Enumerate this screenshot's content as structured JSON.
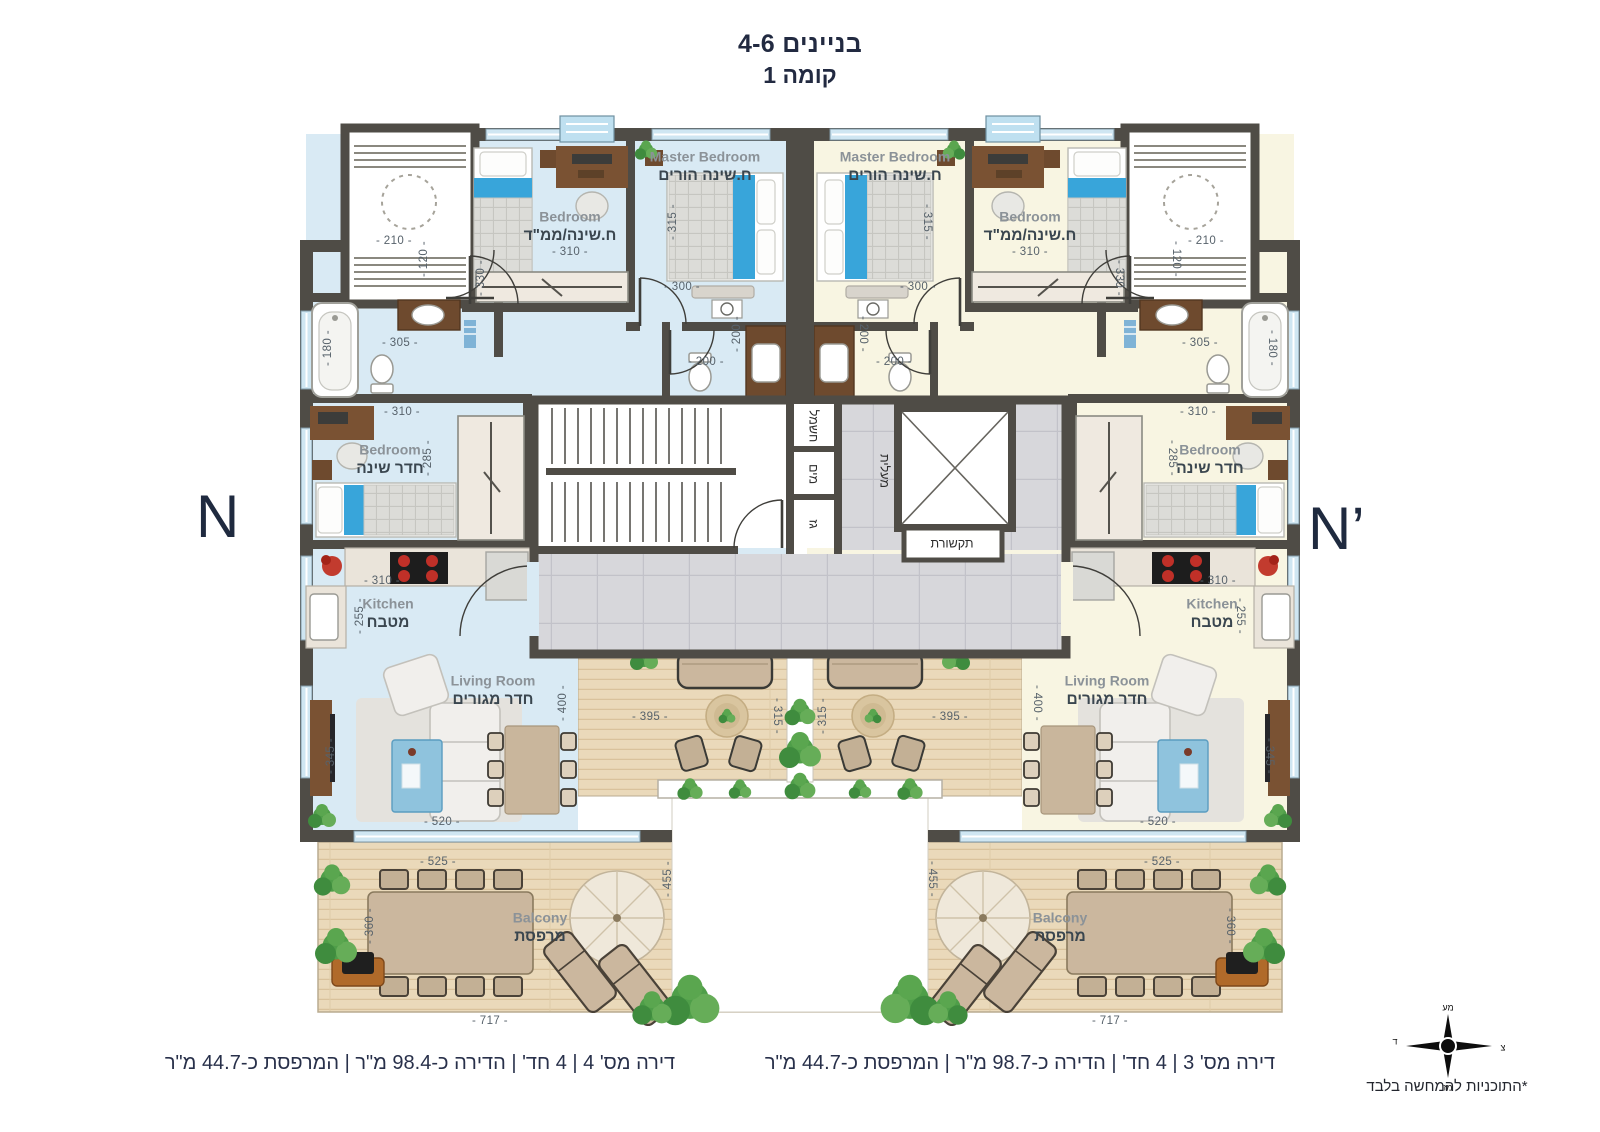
{
  "title": {
    "building": "בניינים 4-6",
    "floor": "קומה 1"
  },
  "markers": {
    "left": "N",
    "right": "N’"
  },
  "captions": {
    "left_apartment": "דירה מס' 4 | 4 חד' | הדירה כ-98.4 מ\"ר | המרפסת כ-44.7 מ\"ר",
    "right_apartment": "דירה מס' 3 | 4 חד' | הדירה כ-98.7 מ\"ר | המרפסת כ-44.7 מ\"ר"
  },
  "disclaimer": "*התוכניות להמחשה בלבד",
  "compass": {
    "top": "מע",
    "right": "צ",
    "bottom": "מז",
    "left": "ד"
  },
  "colors": {
    "apartment_left_fill": "#d9eaf4",
    "apartment_right_fill": "#f8f5e2",
    "wall": "#4f4c46",
    "wood_deck": "#ead9ba",
    "lobby_tile": "#d7d7db",
    "accent_blue": "#38a5da",
    "text_navy": "#222a41"
  },
  "plan": {
    "room_labels": [
      {
        "en": "Bedroom",
        "he": "ח.שינה/ממ\"ד",
        "x": 570,
        "y": 218
      },
      {
        "en": "Master Bedroom",
        "he": "ח.שינה הורים",
        "x": 705,
        "y": 158
      },
      {
        "en": "Bedroom",
        "he": "חדר שינה",
        "x": 390,
        "y": 451
      },
      {
        "en": "Kitchen",
        "he": "מטבח",
        "x": 388,
        "y": 605
      },
      {
        "en": "Living Room",
        "he": "חדר מגורים",
        "x": 493,
        "y": 682
      },
      {
        "en": "Balcony",
        "he": "מרפסת",
        "x": 540,
        "y": 919
      },
      {
        "en": "Master Bedroom",
        "he": "ח.שינה הורים",
        "x": 895,
        "y": 158
      },
      {
        "en": "Bedroom",
        "he": "ח.שינה/ממ\"ד",
        "x": 1030,
        "y": 218
      },
      {
        "en": "Bedroom",
        "he": "חדר שינה",
        "x": 1210,
        "y": 451
      },
      {
        "en": "Kitchen",
        "he": "מטבח",
        "x": 1212,
        "y": 605
      },
      {
        "en": "Living Room",
        "he": "חדר מגורים",
        "x": 1107,
        "y": 682
      },
      {
        "en": "Balcony",
        "he": "מרפסת",
        "x": 1060,
        "y": 919
      }
    ],
    "core_labels": [
      {
        "t": "מעלית",
        "x": 884,
        "y": 471,
        "r": 90
      },
      {
        "t": "תקשורת",
        "x": 952,
        "y": 544,
        "r": 0
      },
      {
        "t": "חשמל",
        "x": 813,
        "y": 426,
        "r": 90
      },
      {
        "t": "מים",
        "x": 813,
        "y": 474,
        "r": 90
      },
      {
        "t": "גז",
        "x": 813,
        "y": 524,
        "r": 90
      }
    ],
    "dims": [
      {
        "t": "210",
        "x": 394,
        "y": 241,
        "r": 0
      },
      {
        "t": "120",
        "x": 424,
        "y": 259,
        "r": -90
      },
      {
        "t": "330",
        "x": 481,
        "y": 278,
        "r": -90
      },
      {
        "t": "310",
        "x": 570,
        "y": 252,
        "r": 0
      },
      {
        "t": "315",
        "x": 673,
        "y": 222,
        "r": -90
      },
      {
        "t": "300",
        "x": 682,
        "y": 287,
        "r": 0
      },
      {
        "t": "180",
        "x": 328,
        "y": 348,
        "r": -90
      },
      {
        "t": "305",
        "x": 400,
        "y": 343,
        "r": 0
      },
      {
        "t": "310",
        "x": 402,
        "y": 412,
        "r": 0
      },
      {
        "t": "285",
        "x": 428,
        "y": 458,
        "r": -90
      },
      {
        "t": "310",
        "x": 382,
        "y": 581,
        "r": 0
      },
      {
        "t": "255",
        "x": 360,
        "y": 616,
        "r": -90
      },
      {
        "t": "400",
        "x": 563,
        "y": 703,
        "r": -90
      },
      {
        "t": "345",
        "x": 331,
        "y": 756,
        "r": -90
      },
      {
        "t": "520",
        "x": 442,
        "y": 822,
        "r": 0
      },
      {
        "t": "525",
        "x": 438,
        "y": 862,
        "r": 0
      },
      {
        "t": "360",
        "x": 370,
        "y": 926,
        "r": -90
      },
      {
        "t": "717",
        "x": 490,
        "y": 1021,
        "r": 0
      },
      {
        "t": "455",
        "x": 668,
        "y": 879,
        "r": -90
      },
      {
        "t": "395",
        "x": 650,
        "y": 717,
        "r": 0
      },
      {
        "t": "315",
        "x": 777,
        "y": 716,
        "r": 90
      },
      {
        "t": "200",
        "x": 706,
        "y": 362,
        "r": 0
      },
      {
        "t": "200",
        "x": 737,
        "y": 334,
        "r": -90
      },
      {
        "t": "210",
        "x": 1206,
        "y": 241,
        "r": 0
      },
      {
        "t": "120",
        "x": 1176,
        "y": 259,
        "r": 90
      },
      {
        "t": "330",
        "x": 1119,
        "y": 278,
        "r": 90
      },
      {
        "t": "310",
        "x": 1030,
        "y": 252,
        "r": 0
      },
      {
        "t": "315",
        "x": 927,
        "y": 222,
        "r": 90
      },
      {
        "t": "300",
        "x": 918,
        "y": 287,
        "r": 0
      },
      {
        "t": "180",
        "x": 1272,
        "y": 348,
        "r": 90
      },
      {
        "t": "305",
        "x": 1200,
        "y": 343,
        "r": 0
      },
      {
        "t": "310",
        "x": 1198,
        "y": 412,
        "r": 0
      },
      {
        "t": "285",
        "x": 1172,
        "y": 458,
        "r": 90
      },
      {
        "t": "310",
        "x": 1218,
        "y": 581,
        "r": 0
      },
      {
        "t": "255",
        "x": 1240,
        "y": 616,
        "r": 90
      },
      {
        "t": "400",
        "x": 1037,
        "y": 703,
        "r": 90
      },
      {
        "t": "345",
        "x": 1269,
        "y": 756,
        "r": 90
      },
      {
        "t": "520",
        "x": 1158,
        "y": 822,
        "r": 0
      },
      {
        "t": "525",
        "x": 1162,
        "y": 862,
        "r": 0
      },
      {
        "t": "360",
        "x": 1230,
        "y": 926,
        "r": 90
      },
      {
        "t": "717",
        "x": 1110,
        "y": 1021,
        "r": 0
      },
      {
        "t": "455",
        "x": 932,
        "y": 879,
        "r": 90
      },
      {
        "t": "395",
        "x": 950,
        "y": 717,
        "r": 0
      },
      {
        "t": "315",
        "x": 823,
        "y": 716,
        "r": -90
      },
      {
        "t": "200",
        "x": 894,
        "y": 362,
        "r": 0
      },
      {
        "t": "200",
        "x": 863,
        "y": 334,
        "r": 90
      }
    ]
  }
}
